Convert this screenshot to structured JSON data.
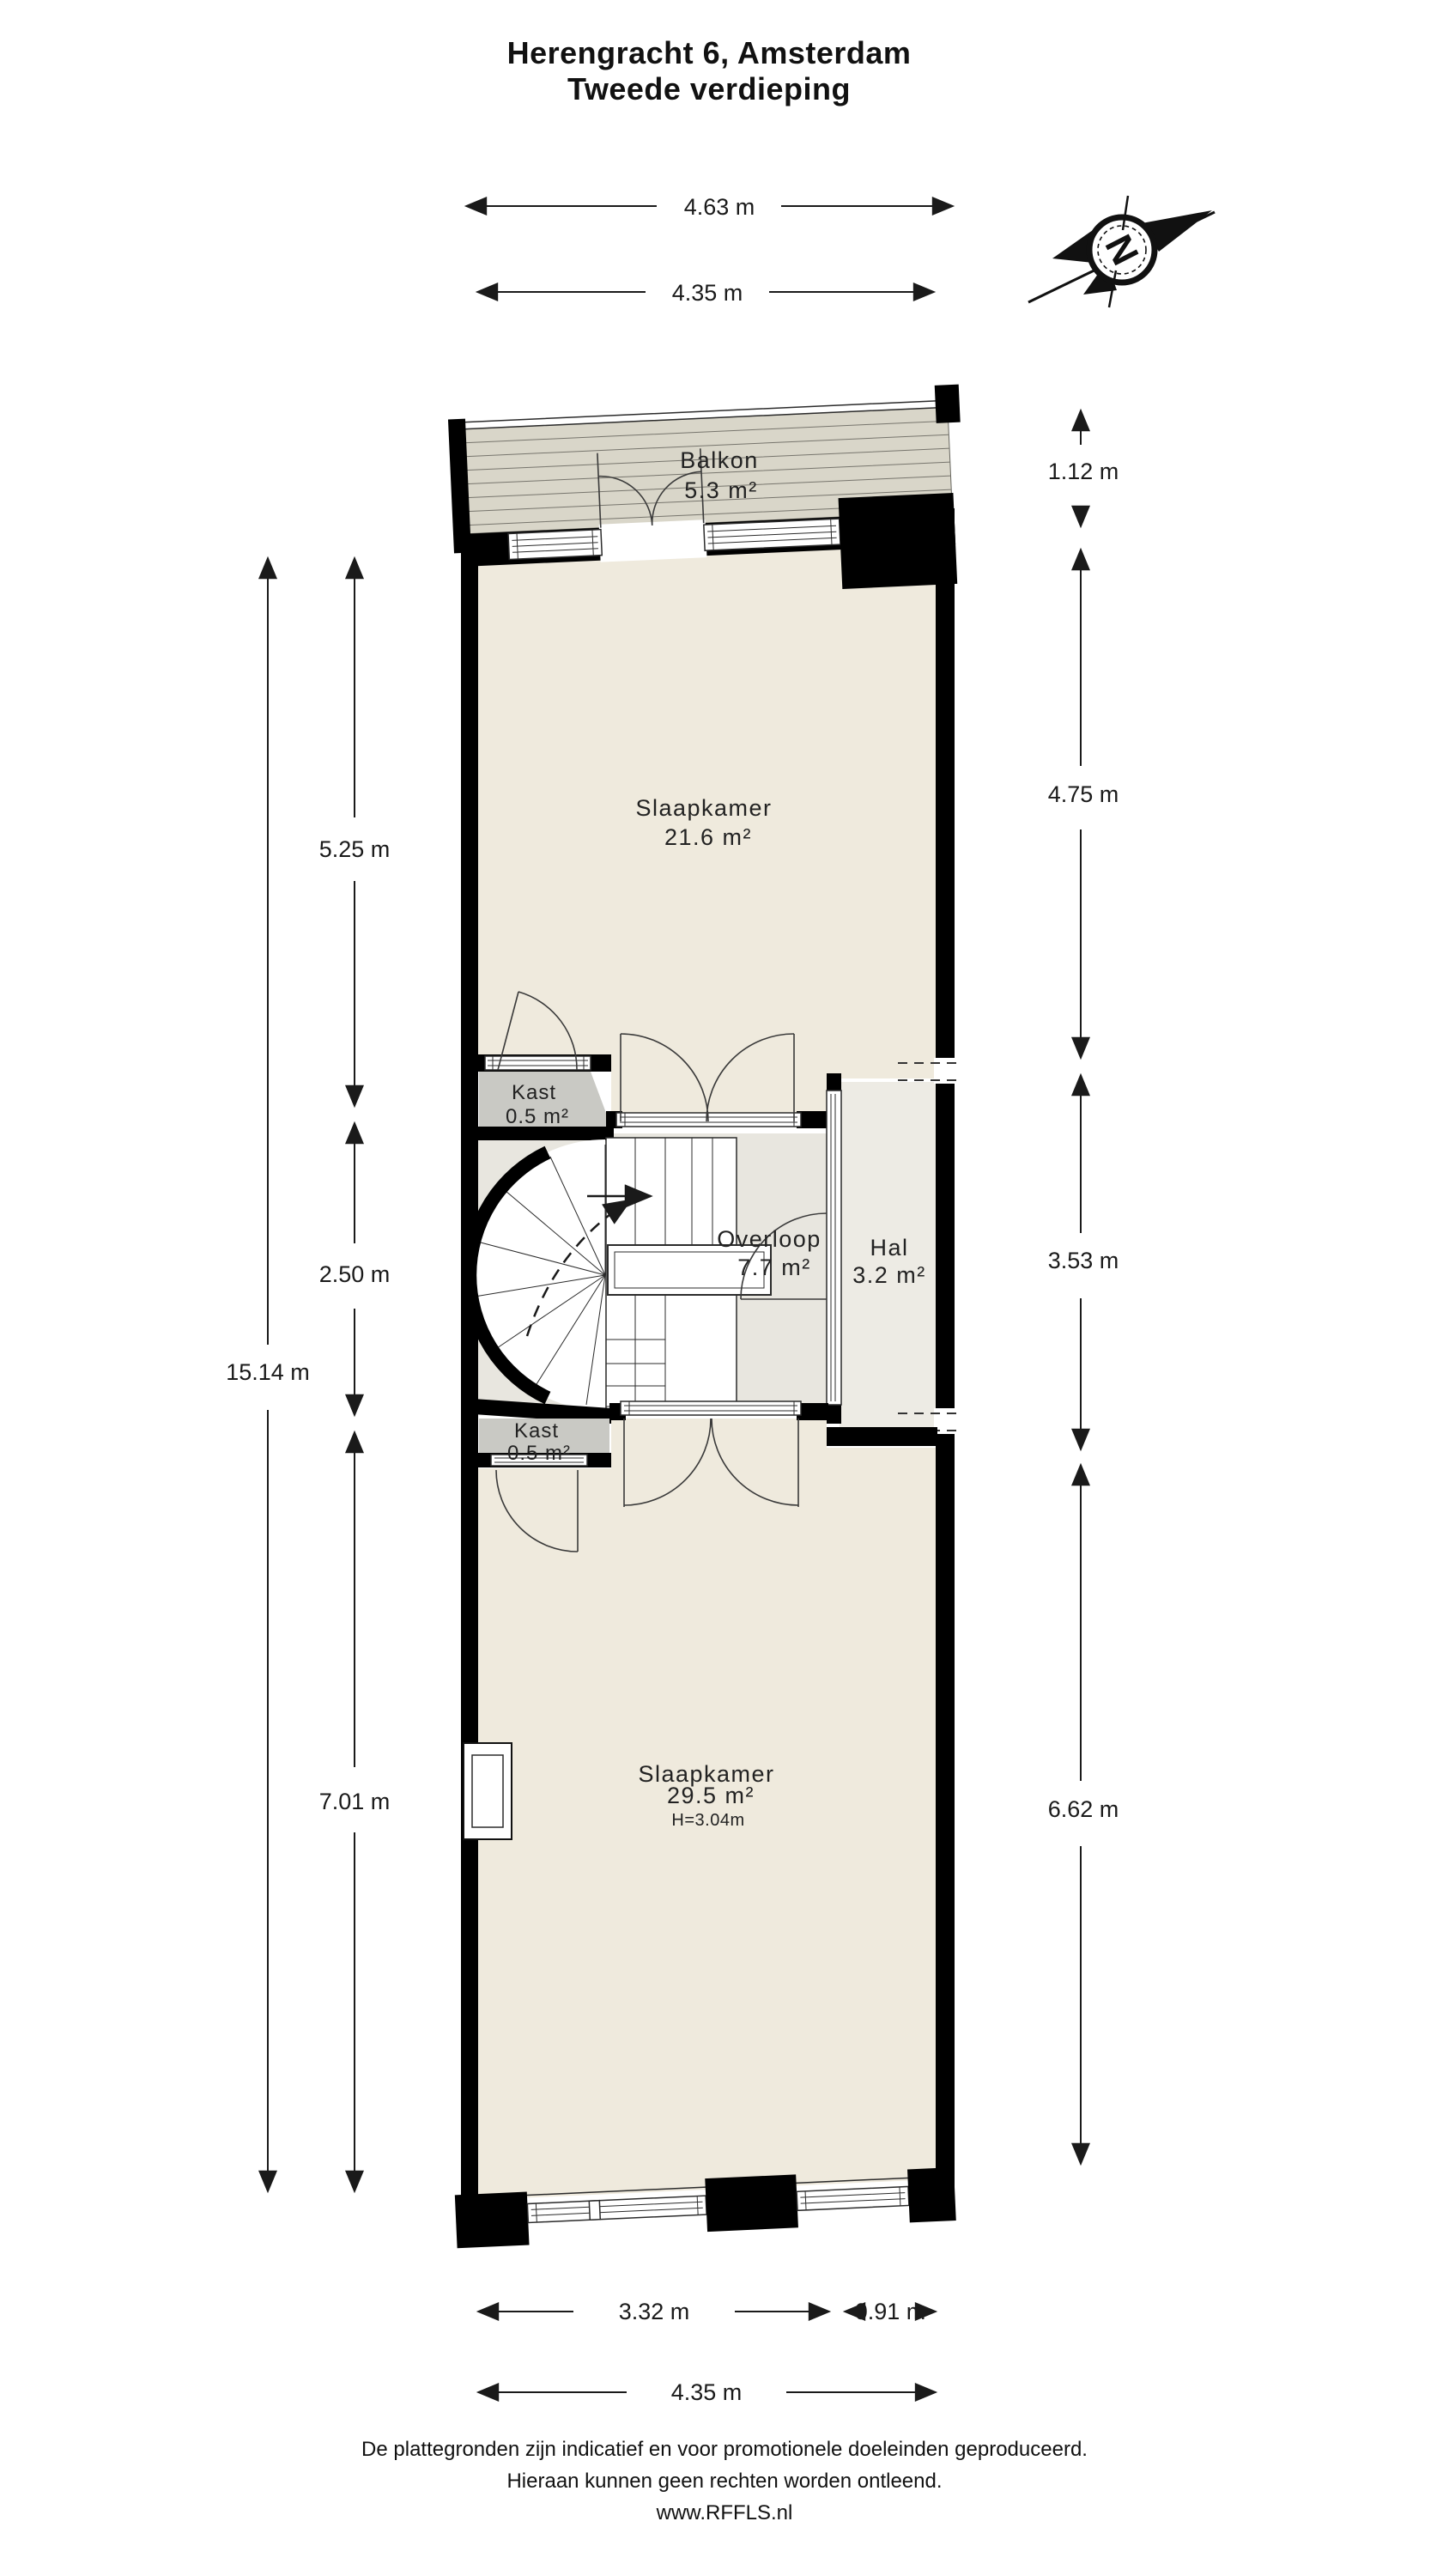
{
  "title": {
    "line1": "Herengracht 6, Amsterdam",
    "line2": "Tweede verdieping"
  },
  "rooms": {
    "balkon": {
      "name": "Balkon",
      "area": "5.3 m²"
    },
    "slaapkamer1": {
      "name": "Slaapkamer",
      "area": "21.6 m²"
    },
    "kast1": {
      "name": "Kast",
      "area": "0.5 m²"
    },
    "overloop": {
      "name": "Overloop",
      "area": "7.7 m²"
    },
    "hal": {
      "name": "Hal",
      "area": "3.2 m²"
    },
    "kast2": {
      "name": "Kast",
      "area": "0.5 m²"
    },
    "slaapkamer2": {
      "name": "Slaapkamer",
      "area": "29.5 m²",
      "ceiling_height": "H=3.04m"
    }
  },
  "dimensions": {
    "top_outer": "4.63 m",
    "top_inner": "4.35 m",
    "right_balkon": "1.12 m",
    "right_slaapkamer1": "4.75 m",
    "right_hal": "3.53 m",
    "right_slaapkamer2": "6.62 m",
    "left_total": "15.14 m",
    "left_slaapkamer1": "5.25 m",
    "left_overloop": "2.50 m",
    "left_slaapkamer2": "7.01 m",
    "bottom_window": "3.32 m",
    "bottom_pier": "0.91 m",
    "bottom_inner": "4.35 m"
  },
  "compass": {
    "letter": "N"
  },
  "footer": {
    "line1": "De plattegronden zijn indicatief en voor promotionele doeleinden geproduceerd.",
    "line2": "Hieraan kunnen geen rechten worden ontleend.",
    "line3": "www.RFFLS.nl"
  },
  "colors": {
    "wall": "#000000",
    "floor_bedroom": "#EFEADD",
    "floor_overloop": "#E8E6DF",
    "floor_hal": "#EDEBE4",
    "kast_gray": "#C9C9C4",
    "balkon_deck": "#D9D6C9",
    "line": "#1A1A1A"
  }
}
